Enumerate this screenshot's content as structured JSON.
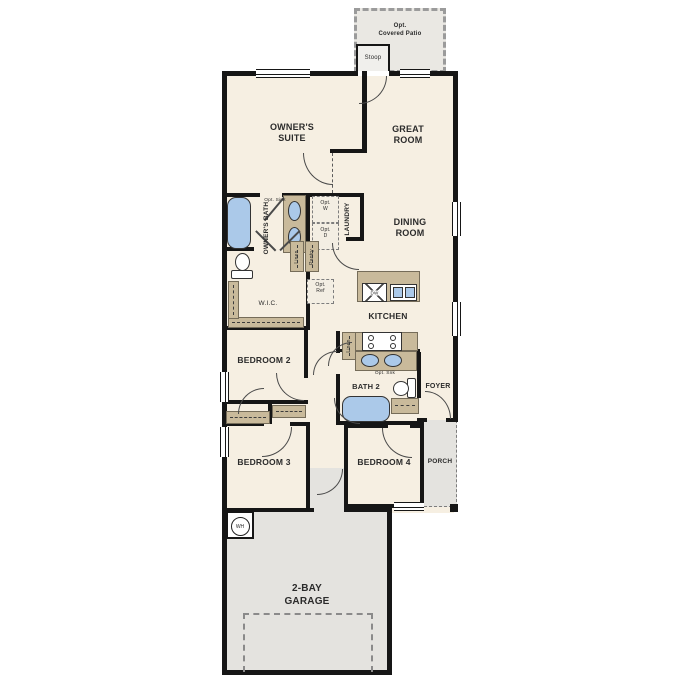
{
  "colors": {
    "floor": "#f6efe2",
    "wall": "#161616",
    "concrete": "#e4e3df",
    "cabinet": "#c9ba9b",
    "water": "#abc9e9"
  },
  "labels": {
    "patio_line1": "Opt.",
    "patio_line2": "Covered Patio",
    "stoop": "Stoop",
    "owners_suite": "OWNER'S SUITE",
    "great_room": "GREAT ROOM",
    "owners_bath": "OWNER'S BATH",
    "opt_sink": "Opt. Sink",
    "opt_w": "Opt. W",
    "opt_d": "Opt. D",
    "laundry": "LAUNDRY",
    "linen_hall": "Linen",
    "pantry": "Pantry",
    "opt_ref": "Opt. Ref",
    "dining_room": "DINING ROOM",
    "wic": "W.I.C.",
    "kitchen": "KITCHEN",
    "dw": "DW",
    "linen_kitchen": "Linen",
    "opt_snk": "Opt. Snk",
    "bedroom2": "BEDROOM 2",
    "bath2": "BATH 2",
    "foyer": "FOYER",
    "bedroom3": "BEDROOM 3",
    "bedroom4": "BEDROOM 4",
    "porch": "PORCH",
    "wh": "WH",
    "garage": "2-BAY GARAGE"
  }
}
